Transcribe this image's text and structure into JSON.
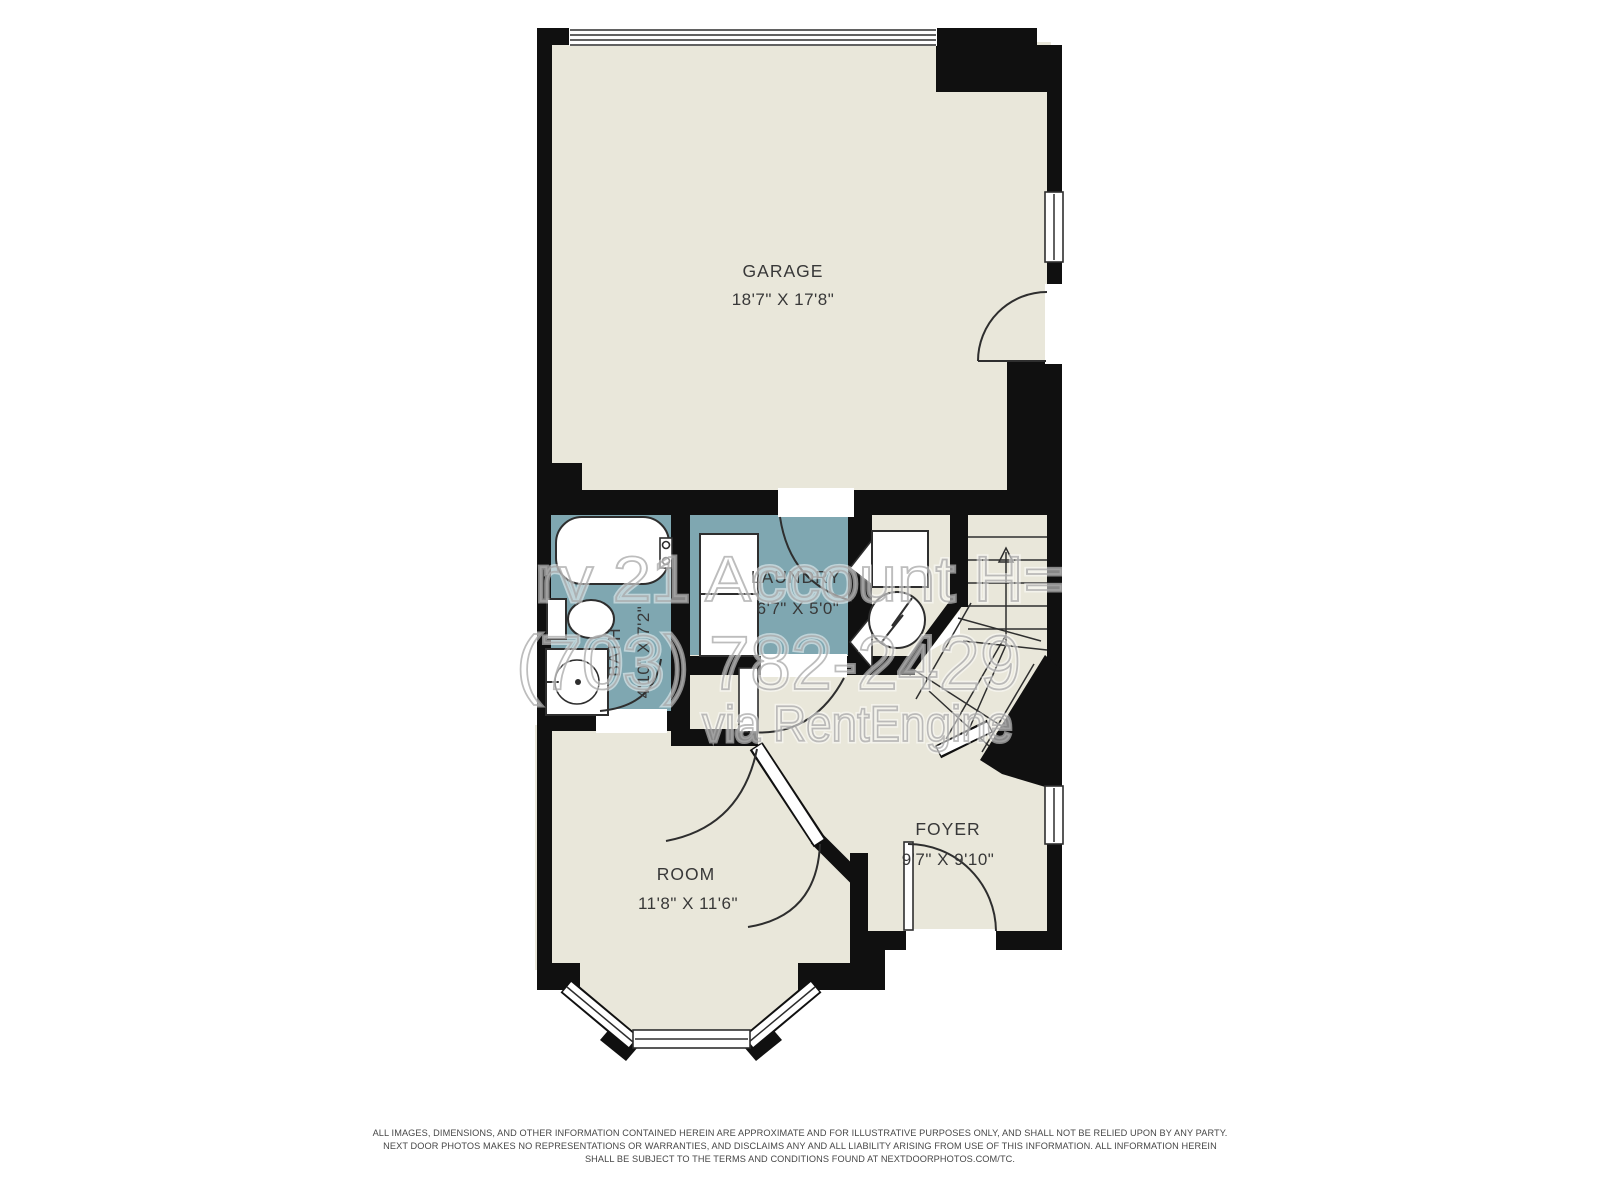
{
  "plan": {
    "type": "floor-plan",
    "colors": {
      "wall": "#101010",
      "floor": "#e9e7da",
      "wet_room_floor": "#7fa7b1",
      "background": "#ffffff"
    },
    "rooms": {
      "garage": {
        "label": "GARAGE",
        "dims": "18'7\" X 17'8\""
      },
      "laundry": {
        "label": "LAUNDRY",
        "dims": "6'7\" X 5'0\""
      },
      "bath": {
        "label": "BATH",
        "dims": "4'10\" X 7'2\""
      },
      "room": {
        "label": "ROOM",
        "dims": "11'8\" X 11'6\""
      },
      "foyer": {
        "label": "FOYER",
        "dims": "9'7\" X 9'10\""
      }
    },
    "fixtures": [
      "bathtub",
      "toilet",
      "vanity-sink",
      "washer-dryer-stack",
      "furnace",
      "water-heater",
      "stairs-up"
    ]
  },
  "watermark": {
    "line1": "rv 21 Account H=",
    "line2": "(703) 782-2429",
    "line3": "via RentEngine"
  },
  "disclaimer": {
    "line1": "ALL IMAGES, DIMENSIONS, AND OTHER INFORMATION CONTAINED HEREIN ARE APPROXIMATE AND FOR ILLUSTRATIVE PURPOSES ONLY, AND SHALL NOT BE RELIED UPON BY ANY PARTY.",
    "line2": "NEXT DOOR PHOTOS MAKES NO REPRESENTATIONS OR WARRANTIES, AND DISCLAIMS ANY AND ALL LIABILITY ARISING FROM USE OF THIS INFORMATION. ALL INFORMATION HEREIN",
    "line3": "SHALL BE SUBJECT TO THE TERMS AND CONDITIONS FOUND AT NEXTDOORPHOTOS.COM/TC."
  }
}
